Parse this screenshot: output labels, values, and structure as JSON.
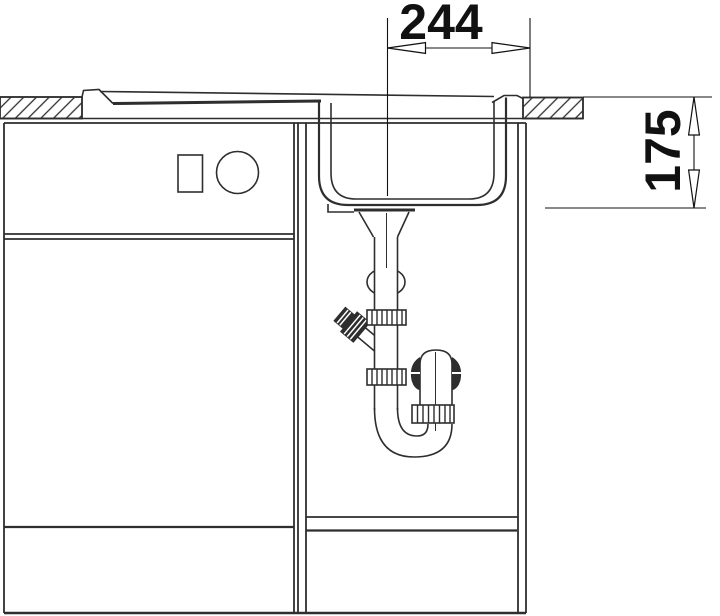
{
  "diagram": {
    "type": "sink-installation-cross-section",
    "dimension_width": {
      "value": "244",
      "orientation": "horizontal",
      "arrow_style": "open-outward"
    },
    "dimension_depth": {
      "value": "175",
      "orientation": "vertical",
      "arrow_style": "open-outward"
    },
    "colors": {
      "line": "#2e2e2e",
      "dimension": "#111111",
      "background": "#ffffff",
      "knurl_dark": "#2e2e2e"
    },
    "icons": {
      "countertop_section": "diagonal-hatch-icon",
      "drawer_symbols": [
        "square-symbol-icon",
        "circle-symbol-icon"
      ]
    }
  }
}
